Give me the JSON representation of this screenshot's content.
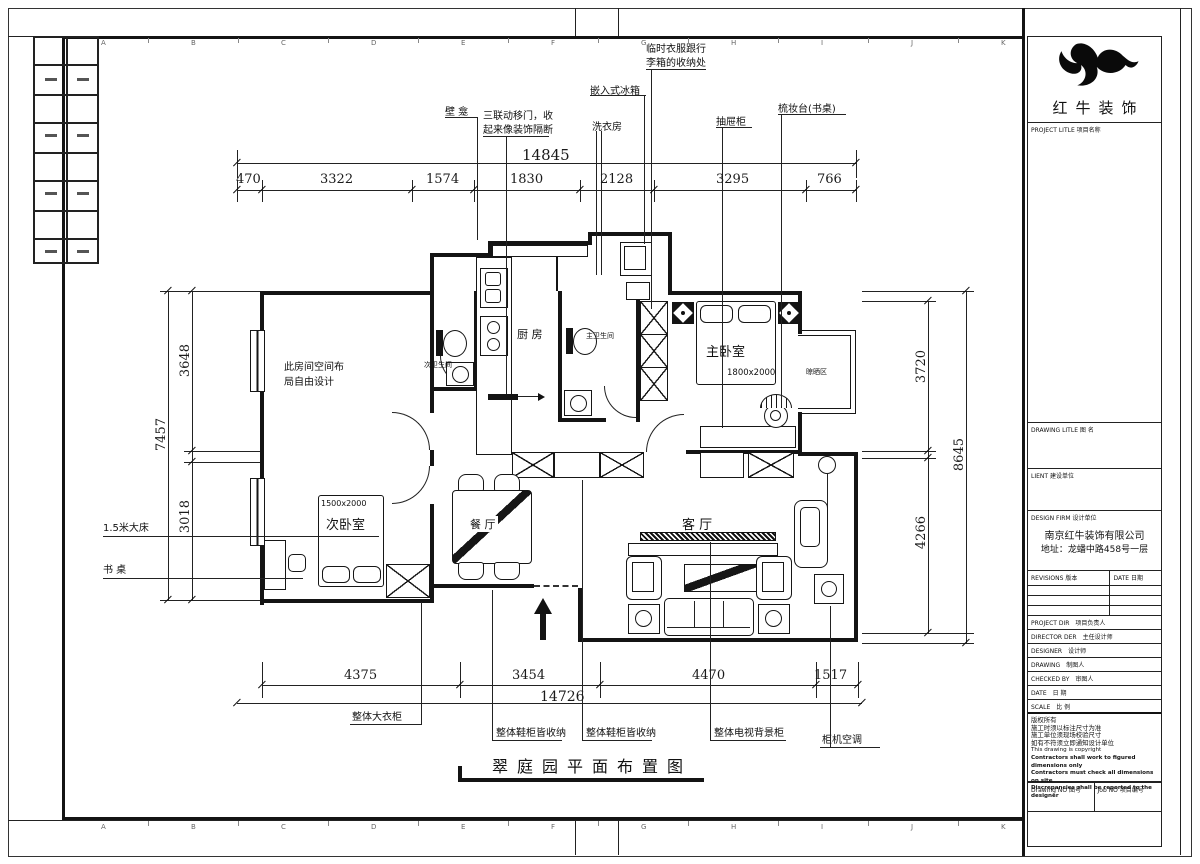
{
  "sheet": {
    "grid_top": [
      "A",
      "B",
      "C",
      "D",
      "E",
      "F",
      "G",
      "H",
      "I",
      "J",
      "K"
    ],
    "grid_bottom": [
      "A",
      "B",
      "C",
      "D",
      "E",
      "F",
      "G",
      "H",
      "I",
      "J",
      "K"
    ]
  },
  "plan": {
    "title": "翠庭园平面布置图",
    "rooms": {
      "kitchen": "厨  房",
      "master_bedroom": "主卧室",
      "master_bath": "主卫生间",
      "second_bath": "次卫生间",
      "second_bedroom": "次卧室",
      "living": "客  厅",
      "dining": "餐  厅",
      "drying": "晾晒区",
      "flex_note_1": "此房间空间布",
      "flex_note_2": "局自由设计",
      "bed_master": "1800x2000",
      "bed_second": "1500x2000"
    },
    "callouts": {
      "niche": "壁 龛",
      "sliding_1": "三联动移门，收",
      "sliding_2": "起来像装饰隔断",
      "laundry": "洗衣房",
      "fridge": "嵌入式冰箱",
      "luggage_1": "临时衣服跟行",
      "luggage_2": "李箱的收纳处",
      "drawers": "抽屉柜",
      "dresser": "梳妆台(书桌)",
      "bed15": "1.5米大床",
      "desk": "书 桌",
      "wardrobe": "整体大衣柜",
      "shoe1": "整体鞋柜皆收纳",
      "shoe2": "整体鞋柜皆收纳",
      "tvwall": "整体电视背景柜",
      "ac": "柜机空调"
    },
    "dims": {
      "top_total": "14845",
      "top": [
        "470",
        "3322",
        "1574",
        "1830",
        "2128",
        "3295",
        "766"
      ],
      "left": [
        "3648",
        "7457",
        "3018"
      ],
      "right": [
        "3720",
        "8645",
        "4266"
      ],
      "bottom": [
        "4375",
        "3454",
        "4470",
        "1517"
      ],
      "bottom_total": "14726"
    }
  },
  "title_block": {
    "logo": "红牛装饰",
    "project_label": "PROJECT LITLE",
    "project_label_cn": "项目名称",
    "drawing_label": "DRAWING LITLE",
    "drawing_label_cn": "图 名",
    "client_label": "LIENT",
    "client_label_cn": "建设单位",
    "firm_label": "DESIGN FIRM",
    "firm_label_cn": "设计单位",
    "firm_name": "南京红牛装饰有限公司",
    "firm_addr": "地址：龙蟠中路458号一层",
    "revisions_label": "REVISIONS 版本",
    "date_col_label": "DATE 日期",
    "rows": [
      {
        "en": "PROJECT DIR",
        "cn": "项目负责人"
      },
      {
        "en": "DIRECTOR DER",
        "cn": "主任设计师"
      },
      {
        "en": "DESIGNER",
        "cn": "设计师"
      },
      {
        "en": "DRAWING",
        "cn": "制图人"
      },
      {
        "en": "CHECKED BY",
        "cn": "审图人"
      },
      {
        "en": "DATE",
        "cn": "日  期"
      },
      {
        "en": "SCALE",
        "cn": "比  例"
      }
    ],
    "notes": [
      "版权所有",
      "施工时须以标注尺寸为准",
      "施工单位须现场校验尺寸",
      "如有不符须立即通知设计单位",
      "This drawing is copyright",
      "Contractors shall work to figured dimensions only",
      "Contractors must check all dimensions on site",
      "Discrepancies shall be reported to the designer"
    ],
    "drawing_no_label": "Drawing NO  图号",
    "job_no_label": "Job NO  项目编号"
  }
}
